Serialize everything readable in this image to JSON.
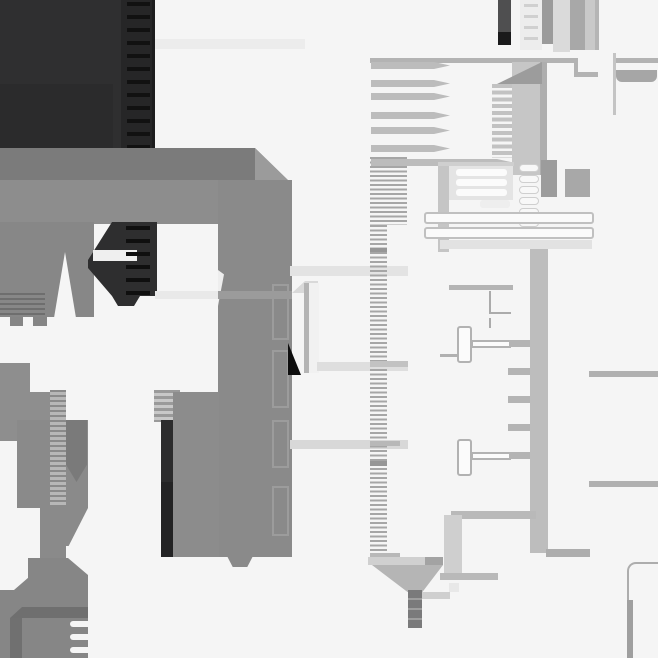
{
  "meta": {
    "description": "Abstract monochrome geometric composition resembling an extreme zoom of a technical drawing: dark charcoal block with dashed zipper strip, large gray C/staple shape, ruler tick strips, pin combs, capsule rows and thin line details.",
    "canvas": {
      "width": 658,
      "height": 658,
      "background": "#f5f5f5"
    },
    "palette": {
      "background": "#f5f5f5",
      "dark_charcoal": "#2f2f30",
      "near_black": "#0e0e0e",
      "mid_gray": "#8a8a8a",
      "slab_gray": "#c6c6c6",
      "column_gray": "#bdbdbd",
      "line_gray": "#b0b0b0",
      "light_band": "#e4e4e4",
      "capsule_white": "#f8f8f8"
    }
  },
  "shapes": [
    {
      "n": "dark-block",
      "x": 0,
      "y": 0,
      "w": 155,
      "h": 150,
      "c": "#2f2f30"
    },
    {
      "n": "dark-block-inner",
      "x": 0,
      "y": 84,
      "w": 113,
      "h": 66,
      "c": "#2b2b2c"
    },
    {
      "n": "zipper-strip",
      "x": 121,
      "y": 0,
      "w": 34,
      "h": 150,
      "c": "#262627"
    },
    {
      "n": "zipper-dashes",
      "x": 127,
      "y": 2,
      "w": 23,
      "h": 148,
      "g": "repeating-linear-gradient(180deg,#111111 0 4px,rgba(0,0,0,0) 4px 13px)"
    },
    {
      "n": "zipper-edge",
      "x": 152,
      "y": 0,
      "w": 3,
      "h": 150,
      "c": "#1d1d1e"
    },
    {
      "n": "c-top-arm",
      "x": 0,
      "y": 148,
      "w": 292,
      "h": 76,
      "c": "#8d8d8d",
      "clip": "polygon(0 0,255px 0,292px 36px,292px 76px,0 76px)"
    },
    {
      "n": "c-top-arm-shade",
      "x": 0,
      "y": 148,
      "w": 255,
      "h": 32,
      "c": "#7b7b7b"
    },
    {
      "n": "c-bevel-face",
      "x": 255,
      "y": 148,
      "w": 37,
      "h": 36,
      "c": "#9b9b9b",
      "clip": "polygon(0 0,100% 100%,0 100%)"
    },
    {
      "n": "c-left-arm",
      "x": 0,
      "y": 222,
      "w": 94,
      "h": 95,
      "c": "#878787"
    },
    {
      "n": "left-arm-ridges",
      "x": 0,
      "y": 293,
      "w": 45,
      "h": 24,
      "g": "repeating-linear-gradient(180deg,#6e6e6e 0 2px,rgba(0,0,0,0) 2px 5px)"
    },
    {
      "n": "left-arm-notch",
      "x": 54,
      "y": 252,
      "w": 22,
      "h": 66,
      "c": "#f5f5f5",
      "clip": "polygon(50% 0,100% 100%,0 100%)"
    },
    {
      "n": "left-arm-tooth-1",
      "x": 10,
      "y": 317,
      "w": 13,
      "h": 9,
      "c": "#858585"
    },
    {
      "n": "left-arm-tooth-2",
      "x": 33,
      "y": 317,
      "w": 14,
      "h": 9,
      "c": "#858585"
    },
    {
      "n": "zipper-slider",
      "x": 88,
      "y": 220,
      "w": 69,
      "h": 86,
      "c": "#2e2e2f",
      "clip": "polygon(24px 2px,100% 2px,100% 76px,52px 76px,46px 86px,30px 86px,24px 76px,0 48px,0 40px)"
    },
    {
      "n": "slider-slot",
      "x": 93,
      "y": 250,
      "w": 44,
      "h": 11,
      "c": "#efefef"
    },
    {
      "n": "slider-ticks",
      "x": 126,
      "y": 226,
      "w": 24,
      "h": 70,
      "g": "repeating-linear-gradient(180deg,#0f0f0f 0 4px,rgba(0,0,0,0) 4px 13px)"
    },
    {
      "n": "c-right-arm",
      "x": 218,
      "y": 180,
      "w": 74,
      "h": 377,
      "c": "#8a8a8a"
    },
    {
      "n": "right-arm-sliver",
      "x": 218,
      "y": 270,
      "w": 6,
      "h": 36,
      "c": "#eeeeee",
      "clip": "polygon(0 0,100% 12%,0 100%)"
    },
    {
      "n": "arm-inset-1",
      "x": 272,
      "y": 284,
      "w": 17,
      "h": 56,
      "b": "2px solid #9c9c9c"
    },
    {
      "n": "arm-inset-2",
      "x": 272,
      "y": 350,
      "w": 17,
      "h": 58,
      "b": "2px solid #9c9c9c"
    },
    {
      "n": "arm-inset-3",
      "x": 272,
      "y": 420,
      "w": 17,
      "h": 48,
      "b": "2px solid #9c9c9c"
    },
    {
      "n": "arm-inset-4",
      "x": 272,
      "y": 486,
      "w": 17,
      "h": 50,
      "b": "2px solid #9c9c9c"
    },
    {
      "n": "right-arm-tooth",
      "x": 227,
      "y": 556,
      "w": 26,
      "h": 11,
      "c": "#8a8a8a",
      "clip": "polygon(0 0,100% 0,78% 100%,22% 100%)"
    },
    {
      "n": "band-left-white",
      "x": 155,
      "y": 291,
      "w": 63,
      "h": 8,
      "c": "#e9e9e9"
    },
    {
      "n": "band-left-gray",
      "x": 218,
      "y": 291,
      "w": 74,
      "h": 8,
      "c": "#9b9b9b"
    },
    {
      "n": "band-top",
      "x": 155,
      "y": 39,
      "w": 150,
      "h": 10,
      "c": "#ececec"
    },
    {
      "n": "ladder-cap",
      "x": 154,
      "y": 390,
      "w": 26,
      "h": 32,
      "g": "repeating-linear-gradient(180deg,#9a9a9a 0 3px,#c8c8c8 3px 6px)"
    },
    {
      "n": "dark-bar",
      "x": 161,
      "y": 420,
      "w": 12,
      "h": 137,
      "c": "#2c2c2d"
    },
    {
      "n": "dark-bar-lower",
      "x": 161,
      "y": 482,
      "w": 12,
      "h": 75,
      "c": "#232324"
    },
    {
      "n": "dark-bar-foot",
      "x": 173,
      "y": 550,
      "w": 12,
      "h": 7,
      "c": "#8a8a8a"
    },
    {
      "n": "slab-right",
      "x": 173,
      "y": 392,
      "w": 46,
      "h": 165,
      "c": "#8c8c8c"
    },
    {
      "n": "far-left-bar",
      "x": 0,
      "y": 363,
      "w": 30,
      "h": 78,
      "c": "#8e8e8e"
    },
    {
      "n": "far-left-step",
      "x": 0,
      "y": 392,
      "w": 58,
      "h": 49,
      "c": "#8e8e8e"
    },
    {
      "n": "left-block",
      "x": 17,
      "y": 420,
      "w": 71,
      "h": 88,
      "c": "#8a8a8a"
    },
    {
      "n": "rib-strip",
      "x": 50,
      "y": 390,
      "w": 16,
      "h": 163,
      "g": "repeating-linear-gradient(180deg,#8a8a8a 0 2px,#b7b7b7 2px 5px)"
    },
    {
      "n": "inner-bar",
      "x": 66,
      "y": 420,
      "w": 21,
      "h": 62,
      "c": "#7a7a7a",
      "clip": "polygon(0 0,100% 0,100% 72%,50% 100%,0 72%)"
    },
    {
      "n": "taper-tri",
      "x": 66,
      "y": 508,
      "w": 22,
      "h": 38,
      "c": "#8a8a8a",
      "clip": "polygon(0 0,100% 0,12% 100%,0 100%)"
    },
    {
      "n": "stem-left",
      "x": 40,
      "y": 505,
      "w": 26,
      "h": 55,
      "c": "#8a8a8a"
    },
    {
      "n": "bottom-block",
      "x": 0,
      "y": 558,
      "w": 88,
      "h": 100,
      "c": "#868686",
      "clip": "polygon(0 0,68px 0,100% 17px,100% 100%,0 100%)"
    },
    {
      "n": "bottom-notch",
      "x": 0,
      "y": 558,
      "w": 28,
      "h": 32,
      "c": "#f5f5f5",
      "clip": "polygon(0 0,100% 0,100% 62%,50% 100%,0 100%)"
    },
    {
      "n": "bottom-dark-band",
      "x": 10,
      "y": 607,
      "w": 78,
      "h": 11,
      "c": "#6f6f6f",
      "clip": "polygon(12px 0,100% 0,100% 100%,0 100%)"
    },
    {
      "n": "bottom-dark-strip",
      "x": 10,
      "y": 618,
      "w": 12,
      "h": 40,
      "c": "#707070"
    },
    {
      "n": "bottom-slot-1",
      "x": 70,
      "y": 621,
      "w": 20,
      "h": 6,
      "c": "#f5f5f5",
      "r": "3px 0 0 3px"
    },
    {
      "n": "bottom-slot-2",
      "x": 70,
      "y": 634,
      "w": 20,
      "h": 6,
      "c": "#f5f5f5",
      "r": "3px 0 0 3px"
    },
    {
      "n": "bottom-slot-3",
      "x": 70,
      "y": 647,
      "w": 20,
      "h": 6,
      "c": "#f5f5f5",
      "r": "3px 0 0 3px"
    },
    {
      "n": "band-center-1",
      "x": 290,
      "y": 266,
      "w": 118,
      "h": 10,
      "c": "#e3e3e3"
    },
    {
      "n": "pillar-bevel",
      "x": 292,
      "y": 281,
      "w": 26,
      "h": 12,
      "c": "#d9d9d9",
      "clip": "polygon(0 100%,50% 0,100% 0,100% 100%)"
    },
    {
      "n": "pillar-edge",
      "x": 304,
      "y": 283,
      "w": 5,
      "h": 90,
      "c": "#b4b4b4"
    },
    {
      "n": "pillar-body",
      "x": 309,
      "y": 283,
      "w": 10,
      "h": 90,
      "c": "#f1f1f1"
    },
    {
      "n": "black-triangle",
      "x": 288,
      "y": 343,
      "w": 13,
      "h": 32,
      "c": "#0e0e0e",
      "clip": "polygon(0 0,100% 100%,0 100%)"
    },
    {
      "n": "band-center-2",
      "x": 317,
      "y": 362,
      "w": 91,
      "h": 9,
      "c": "#dedede"
    },
    {
      "n": "band-center-3",
      "x": 290,
      "y": 440,
      "w": 118,
      "h": 9,
      "c": "#d8d8d8"
    },
    {
      "n": "ruler-upper",
      "x": 370,
      "y": 157,
      "w": 37,
      "h": 68,
      "g": "repeating-linear-gradient(180deg,#a6a6a6 0 2px,rgba(0,0,0,0) 2px 4.5px)"
    },
    {
      "n": "ruler-lower",
      "x": 370,
      "y": 225,
      "w": 17,
      "h": 335,
      "g": "repeating-linear-gradient(180deg,#a6a6a6 0 2px,rgba(0,0,0,0) 2px 4.5px)"
    },
    {
      "n": "ruler-mark-1",
      "x": 370,
      "y": 248,
      "w": 17,
      "h": 4,
      "c": "#969696"
    },
    {
      "n": "ruler-mark-2",
      "x": 370,
      "y": 361,
      "w": 38,
      "h": 6,
      "c": "#c2c2c2"
    },
    {
      "n": "ruler-mark-3",
      "x": 370,
      "y": 441,
      "w": 30,
      "h": 5,
      "c": "#b8b8b8"
    },
    {
      "n": "ruler-mark-4",
      "x": 370,
      "y": 461,
      "w": 17,
      "h": 5,
      "c": "#969696"
    },
    {
      "n": "ruler-mark-5",
      "x": 370,
      "y": 553,
      "w": 30,
      "h": 6,
      "c": "#b8b8b8"
    },
    {
      "n": "sky-bar-1",
      "x": 498,
      "y": 0,
      "w": 13,
      "h": 45,
      "c": "#4f4f50"
    },
    {
      "n": "sky-bar-1-tip",
      "x": 498,
      "y": 32,
      "w": 13,
      "h": 13,
      "c": "#1a1a1b"
    },
    {
      "n": "sky-bar-2",
      "x": 520,
      "y": 0,
      "w": 22,
      "h": 50,
      "c": "#ededed"
    },
    {
      "n": "sky-bar-2-rungs",
      "x": 524,
      "y": 4,
      "w": 14,
      "h": 44,
      "g": "repeating-linear-gradient(180deg,#d0d0d0 0 3px,rgba(0,0,0,0) 3px 11px)"
    },
    {
      "n": "sky-bar-3",
      "x": 542,
      "y": 0,
      "w": 11,
      "h": 44,
      "c": "#9b9b9b"
    },
    {
      "n": "sky-bar-4",
      "x": 553,
      "y": 0,
      "w": 17,
      "h": 52,
      "c": "#dadada"
    },
    {
      "n": "sky-bar-5",
      "x": 570,
      "y": 0,
      "w": 15,
      "h": 50,
      "c": "#a8a8a8"
    },
    {
      "n": "sky-bar-6",
      "x": 585,
      "y": 0,
      "w": 10,
      "h": 50,
      "c": "#c9c9c9"
    },
    {
      "n": "sky-bar-7",
      "x": 595,
      "y": 0,
      "w": 4,
      "h": 50,
      "c": "#b5b5b5"
    },
    {
      "n": "thin-vline",
      "x": 613,
      "y": 53,
      "w": 3,
      "h": 62,
      "c": "#c4c4c4"
    },
    {
      "n": "top-hline",
      "x": 370,
      "y": 58,
      "w": 208,
      "h": 5,
      "c": "#b3b3b3"
    },
    {
      "n": "top-hline-step-v",
      "x": 574,
      "y": 58,
      "w": 4,
      "h": 19,
      "c": "#b3b3b3"
    },
    {
      "n": "top-hline-step-h",
      "x": 578,
      "y": 72,
      "w": 20,
      "h": 5,
      "c": "#b3b3b3"
    },
    {
      "n": "top-hline-right",
      "x": 616,
      "y": 58,
      "w": 42,
      "h": 5,
      "c": "#b3b3b3"
    },
    {
      "n": "rounded-tab",
      "x": 616,
      "y": 70,
      "w": 41,
      "h": 12,
      "c": "#a6a6a6",
      "r": "0 0 6px 6px"
    },
    {
      "n": "pin-1",
      "x": 371,
      "y": 62,
      "w": 79,
      "h": 7,
      "c": "#bcbcbc",
      "clip": "polygon(0 0,63px 0,100% 50%,63px 100%,0 100%)"
    },
    {
      "n": "pin-2",
      "x": 371,
      "y": 80,
      "w": 79,
      "h": 7,
      "c": "#bcbcbc",
      "clip": "polygon(0 0,63px 0,100% 50%,63px 100%,0 100%)"
    },
    {
      "n": "pin-3",
      "x": 371,
      "y": 93,
      "w": 79,
      "h": 7,
      "c": "#bcbcbc",
      "clip": "polygon(0 0,63px 0,100% 50%,63px 100%,0 100%)"
    },
    {
      "n": "pin-4",
      "x": 371,
      "y": 112,
      "w": 79,
      "h": 7,
      "c": "#bcbcbc",
      "clip": "polygon(0 0,63px 0,100% 50%,63px 100%,0 100%)"
    },
    {
      "n": "pin-5",
      "x": 371,
      "y": 127,
      "w": 79,
      "h": 7,
      "c": "#bcbcbc",
      "clip": "polygon(0 0,63px 0,100% 50%,63px 100%,0 100%)"
    },
    {
      "n": "pin-6",
      "x": 371,
      "y": 145,
      "w": 79,
      "h": 7,
      "c": "#bcbcbc",
      "clip": "polygon(0 0,63px 0,100% 50%,63px 100%,0 100%)"
    },
    {
      "n": "pin-7",
      "x": 371,
      "y": 159,
      "w": 142,
      "h": 7,
      "c": "#bcbcbc",
      "clip": "polygon(0 0,126px 0,100% 50%,126px 100%,0 100%)"
    },
    {
      "n": "slab",
      "x": 512,
      "y": 62,
      "w": 30,
      "h": 113,
      "c": "#c6c6c6"
    },
    {
      "n": "slab-edge",
      "x": 540,
      "y": 62,
      "w": 7,
      "h": 113,
      "c": "#aeaeae"
    },
    {
      "n": "slab-ramp",
      "x": 497,
      "y": 62,
      "w": 45,
      "h": 22,
      "c": "#9c9c9c",
      "clip": "polygon(0 100%,100% 0,100% 100%)"
    },
    {
      "n": "comb-teeth",
      "x": 492,
      "y": 84,
      "w": 20,
      "h": 74,
      "g": "repeating-linear-gradient(180deg,#c2c2c2 0 4px,rgba(0,0,0,0) 4px 6.7px)"
    },
    {
      "n": "panel-top",
      "x": 438,
      "y": 162,
      "w": 76,
      "h": 4,
      "c": "#cfcfcf"
    },
    {
      "n": "panel-left",
      "x": 438,
      "y": 166,
      "w": 11,
      "h": 86,
      "c": "#c5c5c5"
    },
    {
      "n": "panel-bg",
      "x": 449,
      "y": 166,
      "w": 64,
      "h": 34,
      "c": "#e4e4e4"
    },
    {
      "n": "panel-cap-1",
      "x": 456,
      "y": 169,
      "w": 51,
      "h": 7,
      "c": "#fbfbfb",
      "r": "3px"
    },
    {
      "n": "panel-cap-2",
      "x": 456,
      "y": 179,
      "w": 51,
      "h": 7,
      "c": "#fbfbfb",
      "r": "3px"
    },
    {
      "n": "panel-cap-3",
      "x": 456,
      "y": 189,
      "w": 51,
      "h": 7,
      "c": "#fbfbfb",
      "r": "3px"
    },
    {
      "n": "panel-cap-4",
      "x": 480,
      "y": 200,
      "w": 30,
      "h": 8,
      "c": "#eeeeee",
      "r": "3px"
    },
    {
      "n": "capsule-1",
      "x": 519,
      "y": 164,
      "w": 20,
      "h": 8,
      "c": "#f8f8f8",
      "b": "1px solid #cfcfcf",
      "r": "4px"
    },
    {
      "n": "capsule-2",
      "x": 519,
      "y": 175,
      "w": 20,
      "h": 8,
      "c": "#f8f8f8",
      "b": "1px solid #cfcfcf",
      "r": "4px"
    },
    {
      "n": "capsule-3",
      "x": 519,
      "y": 186,
      "w": 20,
      "h": 8,
      "c": "#f8f8f8",
      "b": "1px solid #cfcfcf",
      "r": "4px"
    },
    {
      "n": "capsule-4",
      "x": 519,
      "y": 197,
      "w": 20,
      "h": 8,
      "c": "#f8f8f8",
      "b": "1px solid #cfcfcf",
      "r": "4px"
    },
    {
      "n": "capsule-5",
      "x": 519,
      "y": 208,
      "w": 20,
      "h": 8,
      "c": "#f8f8f8",
      "b": "1px solid #cfcfcf",
      "r": "4px"
    },
    {
      "n": "capsule-6",
      "x": 519,
      "y": 219,
      "w": 20,
      "h": 8,
      "c": "#f8f8f8",
      "b": "1px solid #cfcfcf",
      "r": "4px"
    },
    {
      "n": "capsule-7",
      "x": 519,
      "y": 230,
      "w": 20,
      "h": 8,
      "c": "#f8f8f8",
      "b": "1px solid #cfcfcf",
      "r": "4px"
    },
    {
      "n": "block-dark",
      "x": 541,
      "y": 160,
      "w": 16,
      "h": 37,
      "c": "#9c9c9c"
    },
    {
      "n": "block-mid",
      "x": 565,
      "y": 169,
      "w": 25,
      "h": 28,
      "c": "#a8a8a8"
    },
    {
      "n": "rail-1",
      "x": 424,
      "y": 212,
      "w": 170,
      "h": 12,
      "c": "#fafafa",
      "b": "2px solid #c0c0c0",
      "r": "3px"
    },
    {
      "n": "rail-2",
      "x": 424,
      "y": 227,
      "w": 170,
      "h": 12,
      "c": "#fafafa",
      "b": "2px solid #c0c0c0",
      "r": "3px"
    },
    {
      "n": "band-below-rails",
      "x": 440,
      "y": 240,
      "w": 152,
      "h": 9,
      "c": "#e2e2e2"
    },
    {
      "n": "column",
      "x": 530,
      "y": 249,
      "w": 18,
      "h": 304,
      "c": "#bdbdbd"
    },
    {
      "n": "column-foot",
      "x": 546,
      "y": 549,
      "w": 44,
      "h": 8,
      "c": "#adadad"
    },
    {
      "n": "line-right-1",
      "x": 589,
      "y": 371,
      "w": 69,
      "h": 6,
      "c": "#b0b0b0"
    },
    {
      "n": "line-right-2",
      "x": 589,
      "y": 481,
      "w": 69,
      "h": 6,
      "c": "#b0b0b0"
    },
    {
      "n": "cap-line",
      "x": 449,
      "y": 285,
      "w": 64,
      "h": 5,
      "c": "#b4b4b4"
    },
    {
      "n": "l-line-v1",
      "x": 489,
      "y": 291,
      "w": 2,
      "h": 23,
      "c": "#ababab"
    },
    {
      "n": "l-line-h",
      "x": 489,
      "y": 312,
      "w": 22,
      "h": 2,
      "c": "#ababab"
    },
    {
      "n": "l-line-v2",
      "x": 489,
      "y": 318,
      "w": 2,
      "h": 10,
      "c": "#ababab"
    },
    {
      "n": "tbone-1",
      "x": 457,
      "y": 326,
      "w": 15,
      "h": 37,
      "c": "#fbfbfb",
      "b": "2px solid #b2b2b2",
      "r": "3px"
    },
    {
      "n": "tbone-1-arm",
      "x": 471,
      "y": 340,
      "w": 40,
      "h": 8,
      "c": "#fbfbfb",
      "b": "2px solid #b2b2b2"
    },
    {
      "n": "tbone-1-stub",
      "x": 509,
      "y": 340,
      "w": 21,
      "h": 7,
      "c": "#b4b4b4"
    },
    {
      "n": "h-small",
      "x": 440,
      "y": 354,
      "w": 18,
      "h": 3,
      "c": "#b0b0b0"
    },
    {
      "n": "tab-1",
      "x": 508,
      "y": 368,
      "w": 22,
      "h": 7,
      "c": "#b4b4b4"
    },
    {
      "n": "tab-2",
      "x": 508,
      "y": 396,
      "w": 22,
      "h": 7,
      "c": "#b4b4b4"
    },
    {
      "n": "tab-3",
      "x": 508,
      "y": 424,
      "w": 22,
      "h": 7,
      "c": "#b4b4b4"
    },
    {
      "n": "tbone-2",
      "x": 457,
      "y": 439,
      "w": 15,
      "h": 37,
      "c": "#fbfbfb",
      "b": "2px solid #b2b2b2",
      "r": "3px"
    },
    {
      "n": "tbone-2-arm",
      "x": 471,
      "y": 452,
      "w": 40,
      "h": 8,
      "c": "#fbfbfb",
      "b": "2px solid #b2b2b2"
    },
    {
      "n": "tbone-2-stub",
      "x": 509,
      "y": 452,
      "w": 21,
      "h": 7,
      "c": "#b4b4b4"
    },
    {
      "n": "lower-top-band",
      "x": 451,
      "y": 511,
      "w": 85,
      "h": 8,
      "c": "#b9b9b9"
    },
    {
      "n": "lower-left-strip",
      "x": 444,
      "y": 515,
      "w": 18,
      "h": 62,
      "c": "#cfcfcf"
    },
    {
      "n": "lower-bottom-band",
      "x": 440,
      "y": 573,
      "w": 58,
      "h": 7,
      "c": "#b9b9b9"
    },
    {
      "n": "light-square",
      "x": 449,
      "y": 583,
      "w": 10,
      "h": 9,
      "c": "#e8e8e8"
    },
    {
      "n": "funnel-band",
      "x": 368,
      "y": 557,
      "w": 75,
      "h": 8,
      "c": "#d0d0d0"
    },
    {
      "n": "funnel-band-dark",
      "x": 425,
      "y": 557,
      "w": 18,
      "h": 8,
      "c": "#a3a3a3"
    },
    {
      "n": "funnel",
      "x": 372,
      "y": 565,
      "w": 71,
      "h": 27,
      "c": "#b5b5b5",
      "clip": "polygon(0 0,100% 0,71% 100%,50% 100%)"
    },
    {
      "n": "stem-right-band",
      "x": 412,
      "y": 592,
      "w": 38,
      "h": 7,
      "c": "#cfcfcf"
    },
    {
      "n": "stem",
      "x": 408,
      "y": 590,
      "w": 14,
      "h": 38,
      "c": "#7a7a7b"
    },
    {
      "n": "stem-ticks",
      "x": 408,
      "y": 590,
      "w": 14,
      "h": 38,
      "g": "repeating-linear-gradient(180deg,rgba(0,0,0,0) 0 8px,#9e9e9e 8px 10px)"
    },
    {
      "n": "rounded-corner",
      "x": 627,
      "y": 562,
      "w": 31,
      "h": 16,
      "tl": "2px solid #adadad",
      "r": "9px 0 0 0"
    },
    {
      "n": "rounded-corner-vline",
      "x": 627,
      "y": 576,
      "w": 2,
      "h": 26,
      "c": "#adadad"
    },
    {
      "n": "rounded-corner-bar",
      "x": 627,
      "y": 600,
      "w": 6,
      "h": 58,
      "c": "#9f9f9f"
    }
  ]
}
